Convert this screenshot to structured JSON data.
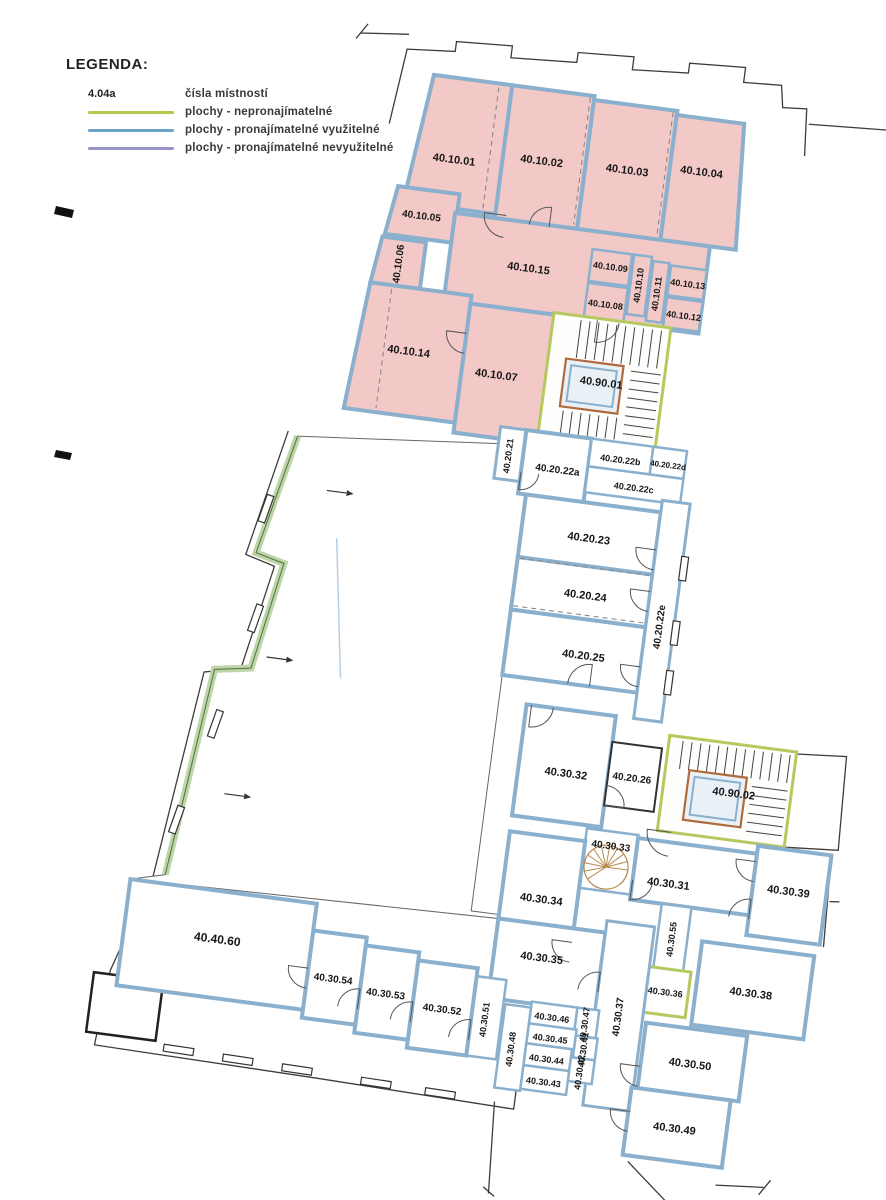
{
  "legend": {
    "title": "LEGENDA:",
    "sample": {
      "label": "4.04a",
      "text": "čísla místností"
    },
    "lines": [
      {
        "name": "non-rentable",
        "color": "#b5c84f",
        "text": "plochy - nepronajímatelné"
      },
      {
        "name": "rentable-usable",
        "color": "#6ba3c8",
        "text": "plochy - pronajímatelné využitelné"
      },
      {
        "name": "rentable-unusable",
        "color": "#9694c6",
        "text": "plochy - pronajímatelné nevyužitelné"
      }
    ]
  },
  "colors": {
    "room_pink_fill": "#f2c9c7",
    "wall_blue": "#8ab0cd",
    "stair_green": "#b5c95e",
    "band_green_light": "#bdd5a8",
    "band_green_dark": "#50703f",
    "elevator_brown": "#b06a3c",
    "spiral_tan": "#b58a4e",
    "thin_line": "#3c3c3c",
    "label_text": "#161616"
  },
  "plan": {
    "rotation": 7.5,
    "cx": 500,
    "cy": 600,
    "rooms": [
      {
        "id": "40.10.01",
        "type": "pink",
        "pts": [
          [
            366,
            88
          ],
          [
            445,
            88
          ],
          [
            445,
            218
          ],
          [
            352,
            218
          ]
        ],
        "lx": 397,
        "ly": 170
      },
      {
        "id": "40.10.02",
        "type": "pink",
        "rect": [
          445,
          88,
          83,
          134
        ],
        "lx": 484,
        "ly": 160
      },
      {
        "id": "40.10.03",
        "type": "pink",
        "rect": [
          528,
          92,
          84,
          130
        ],
        "lx": 570,
        "ly": 158
      },
      {
        "id": "40.10.04",
        "type": "pink",
        "pts": [
          [
            612,
            96
          ],
          [
            680,
            96
          ],
          [
            688,
            222
          ],
          [
            612,
            222
          ]
        ],
        "lx": 644,
        "ly": 150
      },
      {
        "id": "40.10.05",
        "type": "pink",
        "pts": [
          [
            345,
            203
          ],
          [
            407,
            203
          ],
          [
            407,
            252
          ],
          [
            338,
            252
          ]
        ],
        "lx": 372,
        "ly": 230,
        "fs": 10
      },
      {
        "id": "40.10.06",
        "type": "pink",
        "pts": [
          [
            336,
            255
          ],
          [
            380,
            255
          ],
          [
            380,
            302
          ],
          [
            330,
            302
          ]
        ],
        "lx": 356,
        "ly": 280,
        "vert": true,
        "fs": 10
      },
      {
        "id": "40.10.15",
        "type": "pink",
        "rect": [
          405,
          222,
          257,
          88
        ],
        "lx": 485,
        "ly": 268
      },
      {
        "id": "40.10.09",
        "type": "pinkSmall",
        "rect": [
          546,
          240,
          40,
          32
        ],
        "lx": 566,
        "ly": 256,
        "fs": 9
      },
      {
        "id": "40.10.08",
        "type": "pinkSmall",
        "rect": [
          546,
          274,
          40,
          34
        ],
        "lx": 566,
        "ly": 294,
        "fs": 9
      },
      {
        "id": "40.10.10",
        "type": "pinkSmall",
        "rect": [
          588,
          240,
          18,
          60
        ],
        "lx": 597,
        "ly": 270,
        "vert": true,
        "fs": 9
      },
      {
        "id": "40.10.11",
        "type": "pinkSmall",
        "rect": [
          608,
          244,
          16,
          60
        ],
        "lx": 616,
        "ly": 276,
        "vert": true,
        "fs": 9
      },
      {
        "id": "40.10.13",
        "type": "pinkSmall",
        "rect": [
          626,
          246,
          36,
          30
        ],
        "lx": 645,
        "ly": 263,
        "fs": 9
      },
      {
        "id": "40.10.12",
        "type": "pinkSmall",
        "rect": [
          626,
          278,
          36,
          30
        ],
        "lx": 645,
        "ly": 295,
        "fs": 9
      },
      {
        "id": "40.10.14",
        "type": "pink",
        "pts": [
          [
            330,
            302
          ],
          [
            432,
            302
          ],
          [
            432,
            430
          ],
          [
            320,
            430
          ]
        ],
        "lx": 377,
        "ly": 366
      },
      {
        "id": "40.10.07",
        "type": "pink",
        "rect": [
          432,
          310,
          88,
          130
        ],
        "lx": 467,
        "ly": 378
      },
      {
        "id": "40.90.01",
        "type": "stair",
        "rect": [
          516,
          308,
          118,
          122
        ],
        "lx": 572,
        "ly": 372
      },
      {
        "id": "40.20.21",
        "type": "corridor",
        "rect": [
          478,
          428,
          26,
          52
        ],
        "lx": 490,
        "ly": 456,
        "vert": true,
        "fs": 9
      },
      {
        "id": "40.20.22a",
        "type": "white",
        "rect": [
          504,
          428,
          66,
          64
        ],
        "lx": 540,
        "ly": 464,
        "fs": 10
      },
      {
        "id": "40.20.22b",
        "type": "whiteSmall",
        "rect": [
          570,
          428,
          62,
          28
        ],
        "lx": 601,
        "ly": 446,
        "fs": 9
      },
      {
        "id": "40.20.22d",
        "type": "whiteSmall",
        "rect": [
          632,
          428,
          34,
          28
        ],
        "lx": 649,
        "ly": 445,
        "fs": 8
      },
      {
        "id": "40.20.22c",
        "type": "whiteSmall",
        "rect": [
          570,
          456,
          96,
          26
        ],
        "lx": 618,
        "ly": 472,
        "fs": 9
      },
      {
        "id": "40.20.23",
        "type": "white",
        "rect": [
          512,
          492,
          136,
          63
        ],
        "lx": 580,
        "ly": 528
      },
      {
        "id": "40.20.24",
        "type": "white",
        "rect": [
          512,
          555,
          136,
          53
        ],
        "lx": 584,
        "ly": 585
      },
      {
        "id": "40.20.25",
        "type": "white",
        "rect": [
          512,
          608,
          136,
          66
        ],
        "lx": 590,
        "ly": 645
      },
      {
        "id": "40.20.22e",
        "type": "corridor",
        "rect": [
          648,
          480,
          28,
          220
        ],
        "lx": 662,
        "ly": 606,
        "vert": true,
        "fs": 10
      },
      {
        "id": "40.30.32",
        "type": "white",
        "rect": [
          540,
          700,
          90,
          112
        ],
        "lx": 588,
        "ly": 764
      },
      {
        "id": "40.20.26",
        "type": "box",
        "rect": [
          630,
          726,
          50,
          64
        ],
        "lx": 654,
        "ly": 760,
        "fs": 10
      },
      {
        "id": "40.90.02",
        "type": "stair",
        "rect": [
          686,
          712,
          128,
          96
        ],
        "lx": 757,
        "ly": 762
      },
      {
        "id": "40.30.33",
        "type": "whiteSmall",
        "rect": [
          616,
          815,
          52,
          60
        ],
        "lx": 642,
        "ly": 830,
        "fs": 10
      },
      {
        "id": "40.30.34",
        "type": "white",
        "rect": [
          540,
          828,
          76,
          88
        ],
        "lx": 580,
        "ly": 892
      },
      {
        "id": "40.30.31",
        "type": "white",
        "rect": [
          668,
          818,
          120,
          62
        ],
        "lx": 704,
        "ly": 860
      },
      {
        "id": "40.30.39",
        "type": "white",
        "rect": [
          788,
          810,
          74,
          90
        ],
        "lx": 824,
        "ly": 852
      },
      {
        "id": "40.30.55",
        "type": "whiteSmall",
        "rect": [
          700,
          880,
          30,
          64
        ],
        "lx": 715,
        "ly": 914,
        "vert": true,
        "fs": 9
      },
      {
        "id": "40.30.35",
        "type": "white",
        "rect": [
          540,
          916,
          108,
          80
        ],
        "lx": 588,
        "ly": 950
      },
      {
        "id": "40.30.36",
        "type": "green",
        "rect": [
          692,
          944,
          46,
          46
        ],
        "lx": 715,
        "ly": 968,
        "fs": 9
      },
      {
        "id": "40.30.38",
        "type": "white",
        "rect": [
          745,
          912,
          113,
          84
        ],
        "lx": 800,
        "ly": 958
      },
      {
        "id": "40.30.37",
        "type": "corridor",
        "rect": [
          648,
          904,
          48,
          186
        ],
        "lx": 672,
        "ly": 998,
        "vert": true,
        "fs": 10
      },
      {
        "id": "40.30.50",
        "type": "white",
        "rect": [
          700,
          1000,
          102,
          66
        ],
        "lx": 749,
        "ly": 1036
      },
      {
        "id": "40.30.49",
        "type": "white",
        "rect": [
          694,
          1066,
          100,
          68
        ],
        "lx": 742,
        "ly": 1102
      },
      {
        "id": "40.30.48",
        "type": "whiteSmall",
        "rect": [
          558,
          1000,
          26,
          84
        ],
        "lx": 570,
        "ly": 1044,
        "vert": true,
        "fs": 9
      },
      {
        "id": "40.30.46",
        "type": "whiteSmall",
        "rect": [
          584,
          994,
          46,
          22
        ],
        "lx": 606,
        "ly": 1008,
        "fs": 9
      },
      {
        "id": "40.30.47",
        "type": "whiteSmall",
        "rect": [
          630,
          994,
          22,
          28
        ],
        "lx": 640,
        "ly": 1010,
        "vert": true,
        "fs": 9
      },
      {
        "id": "40.30.45",
        "type": "whiteSmall",
        "rect": [
          584,
          1016,
          48,
          20
        ],
        "lx": 607,
        "ly": 1029,
        "fs": 9
      },
      {
        "id": "40.30.41",
        "type": "whiteSmall",
        "rect": [
          632,
          1022,
          22,
          22
        ],
        "lx": 642,
        "ly": 1035,
        "vert": true,
        "fs": 9
      },
      {
        "id": "40.30.44",
        "type": "whiteSmall",
        "rect": [
          584,
          1036,
          46,
          22
        ],
        "lx": 606,
        "ly": 1050,
        "fs": 9
      },
      {
        "id": "40.30.42",
        "type": "whiteSmall",
        "rect": [
          630,
          1044,
          24,
          24
        ],
        "lx": 641,
        "ly": 1058,
        "vert": true,
        "fs": 9
      },
      {
        "id": "40.30.43",
        "type": "whiteSmall",
        "rect": [
          584,
          1058,
          46,
          24
        ],
        "lx": 606,
        "ly": 1073,
        "fs": 9
      },
      {
        "id": "40.30.51",
        "type": "whiteSmall",
        "rect": [
          526,
          976,
          30,
          80
        ],
        "lx": 540,
        "ly": 1018,
        "vert": true,
        "fs": 9
      },
      {
        "id": "40.30.52",
        "type": "white",
        "rect": [
          466,
          968,
          60,
          88
        ],
        "lx": 496,
        "ly": 1014,
        "fs": 10
      },
      {
        "id": "40.30.53",
        "type": "white",
        "rect": [
          412,
          960,
          54,
          88
        ],
        "lx": 438,
        "ly": 1006,
        "fs": 10
      },
      {
        "id": "40.30.54",
        "type": "white",
        "rect": [
          358,
          952,
          54,
          88
        ],
        "lx": 384,
        "ly": 998,
        "fs": 10
      },
      {
        "id": "40.40.60",
        "type": "white",
        "rect": [
          170,
          925,
          188,
          107
        ],
        "lx": 264,
        "ly": 974,
        "fs": 12
      }
    ],
    "hall": {
      "pts": [
        [
          278,
          464
        ],
        [
          512,
          442
        ],
        [
          512,
          912
        ],
        [
          540,
          912
        ],
        [
          540,
          916
        ],
        [
          170,
          925
        ],
        [
          204,
          916
        ],
        [
          226,
          706
        ],
        [
          262,
          700
        ],
        [
          281,
          592
        ],
        [
          252,
          585
        ]
      ],
      "band": [
        [
          278,
          464
        ],
        [
          252,
          585
        ],
        [
          281,
          592
        ],
        [
          262,
          700
        ],
        [
          226,
          706
        ],
        [
          204,
          916
        ]
      ]
    },
    "stair_details": [
      {
        "id": "40.90.01",
        "elevator": [
          534,
          352,
          58,
          48
        ],
        "bands": [
          {
            "dir": "v",
            "from": 544,
            "to": 630,
            "step": 9,
            "a": 312,
            "b": 350
          },
          {
            "dir": "h",
            "from": 356,
            "to": 424,
            "step": 9,
            "a": 600,
            "b": 630
          },
          {
            "dir": "v",
            "from": 538,
            "to": 592,
            "step": 9,
            "a": 404,
            "b": 426
          }
        ]
      },
      {
        "id": "40.90.02",
        "elevator": [
          710,
          744,
          58,
          50
        ],
        "bands": [
          {
            "dir": "v",
            "from": 700,
            "to": 808,
            "step": 9,
            "a": 716,
            "b": 744
          },
          {
            "dir": "h",
            "from": 752,
            "to": 802,
            "step": 9,
            "a": 774,
            "b": 810
          }
        ]
      }
    ],
    "spiral": {
      "cx": 640,
      "cy": 851,
      "r": 22
    },
    "black_paths": [
      "M328,142 L336,66 L384,62 L384,52 L440,49 L440,61 L506,57 L506,47 L562,44 L562,57 L618,53 L618,43 L674,40 L674,55 L712,53 L716,75 L740,73 L744,120",
      "M744,88 L868,81 L872,128 L846,130 L852,250",
      "M268,460 L242,588 L272,596 L252,702 L216,710 L192,920 L162,1018 L156,1094 L380,1098 L580,1103 L580,1082",
      "M814,714 L864,710 L868,804 L814,808",
      "M712,856 L712,820",
      "M288,56 L336,51 M284,62 L294,46",
      "M790,1152 L838,1148 M834,1156 L844,1140",
      "M560,1098 L566,1190 M560,1184 L572,1192",
      "M700,1140 L757,1186 M750,1190 L762,1178",
      "M862,810 L866,902 M866,856 L876,855"
    ],
    "screen_marks": [
      "M56,206 L74,210 L72,218 L54,214 Z",
      "M56,450 L72,453 L70,460 L54,457 Z"
    ],
    "outer_black_box": [
      146,
      1022,
      70,
      60
    ],
    "dashed_lines": [
      [
        432,
        92,
        432,
        216
      ],
      [
        524,
        90,
        524,
        218
      ],
      [
        608,
        94,
        608,
        220
      ],
      [
        352,
        306,
        352,
        426
      ],
      [
        514,
        556,
        646,
        556
      ],
      [
        514,
        604,
        646,
        604
      ]
    ],
    "faint_blue_line": [
      330,
      560,
      352,
      698
    ],
    "arrows": [
      [
        314,
        514
      ],
      [
        276,
        687
      ],
      [
        252,
        828
      ]
    ],
    "window_ticks": [
      {
        "x": 240,
        "y": 1088,
        "w": 30,
        "h": 7,
        "rot": 1
      },
      {
        "x": 300,
        "y": 1090,
        "w": 30,
        "h": 7,
        "rot": 1
      },
      {
        "x": 360,
        "y": 1092,
        "w": 30,
        "h": 7,
        "rot": 1
      },
      {
        "x": 440,
        "y": 1095,
        "w": 30,
        "h": 7,
        "rot": 1
      },
      {
        "x": 505,
        "y": 1097,
        "w": 30,
        "h": 7,
        "rot": 1
      },
      {
        "x": 256,
        "y": 540,
        "w": 7,
        "h": 28,
        "rot": 12
      },
      {
        "x": 260,
        "y": 650,
        "w": 7,
        "h": 28,
        "rot": 12
      },
      {
        "x": 234,
        "y": 760,
        "w": 7,
        "h": 28,
        "rot": 12
      },
      {
        "x": 208,
        "y": 860,
        "w": 7,
        "h": 28,
        "rot": 12
      },
      {
        "x": 678,
        "y": 545,
        "w": 7,
        "h": 24,
        "rot": 0
      },
      {
        "x": 678,
        "y": 610,
        "w": 7,
        "h": 24,
        "rot": 0
      },
      {
        "x": 678,
        "y": 660,
        "w": 7,
        "h": 24,
        "rot": 0
      }
    ],
    "door_arcs": [
      {
        "x": 456,
        "y": 218,
        "r": 22,
        "rot": 90
      },
      {
        "x": 500,
        "y": 224,
        "r": 20,
        "rot": 180
      },
      {
        "x": 560,
        "y": 310,
        "r": 22,
        "rot": 0
      },
      {
        "x": 432,
        "y": 340,
        "r": 20,
        "rot": 90
      },
      {
        "x": 504,
        "y": 470,
        "r": 18,
        "rot": 0
      },
      {
        "x": 648,
        "y": 530,
        "r": 20,
        "rot": 90
      },
      {
        "x": 648,
        "y": 572,
        "r": 20,
        "rot": 90
      },
      {
        "x": 648,
        "y": 648,
        "r": 20,
        "rot": 90
      },
      {
        "x": 600,
        "y": 674,
        "r": 22,
        "rot": 180
      },
      {
        "x": 630,
        "y": 790,
        "r": 20,
        "rot": 270
      },
      {
        "x": 700,
        "y": 808,
        "r": 24,
        "rot": 90
      },
      {
        "x": 668,
        "y": 860,
        "r": 20,
        "rot": 0
      },
      {
        "x": 616,
        "y": 930,
        "r": 20,
        "rot": 90
      },
      {
        "x": 648,
        "y": 976,
        "r": 20,
        "rot": 180
      },
      {
        "x": 466,
        "y": 1030,
        "r": 20,
        "rot": 180
      },
      {
        "x": 412,
        "y": 1024,
        "r": 20,
        "rot": 180
      },
      {
        "x": 526,
        "y": 1040,
        "r": 20,
        "rot": 180
      },
      {
        "x": 700,
        "y": 1044,
        "r": 20,
        "rot": 90
      },
      {
        "x": 696,
        "y": 1090,
        "r": 20,
        "rot": 90
      },
      {
        "x": 788,
        "y": 884,
        "r": 20,
        "rot": 180
      },
      {
        "x": 788,
        "y": 826,
        "r": 20,
        "rot": 90
      },
      {
        "x": 545,
        "y": 700,
        "r": 22,
        "rot": 0
      },
      {
        "x": 358,
        "y": 990,
        "r": 20,
        "rot": 90
      }
    ]
  }
}
